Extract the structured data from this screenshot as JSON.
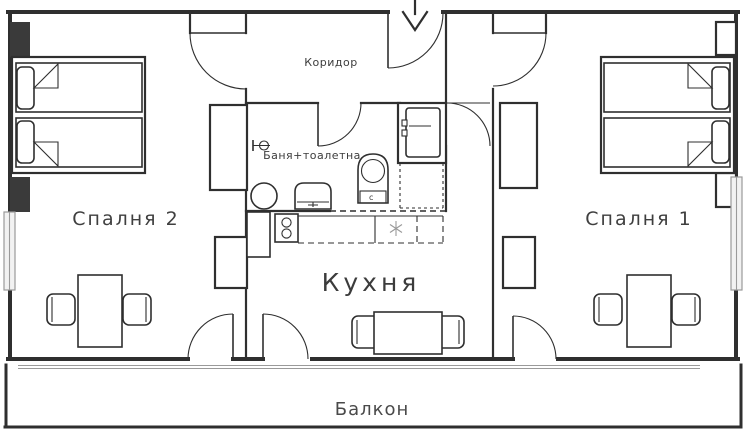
{
  "labels": {
    "corridor": "Коридор",
    "bathroom": "Баня+тоалетна",
    "kitchen": "Кухня",
    "bedroom2": "Спалня 2",
    "bedroom1": "Спалня 1",
    "balcony": "Балкон",
    "boiler": "c"
  },
  "colors": {
    "ink": "#2f2f2f",
    "kitchen_label": "#bcbcbc",
    "window_gray": "#9a9a9a",
    "background": "#ffffff"
  }
}
